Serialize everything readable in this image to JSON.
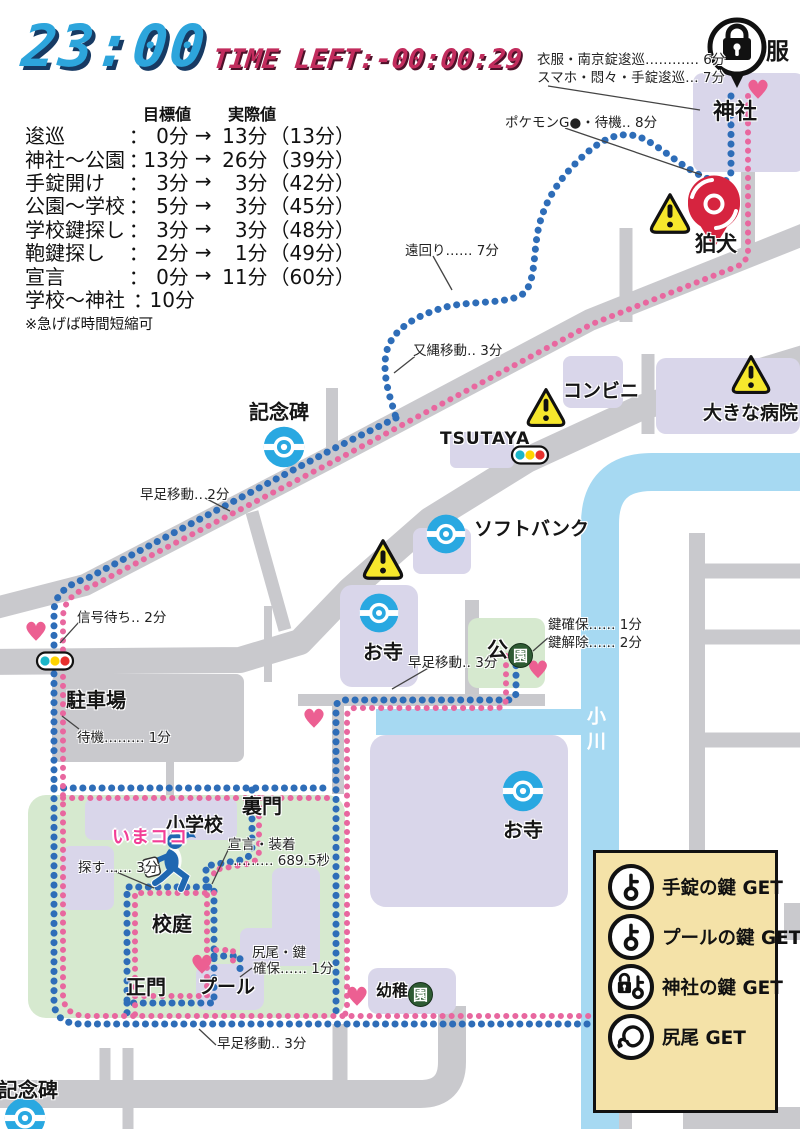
{
  "header": {
    "clock": "23:00",
    "time_left": "TIME LEFT:-00:00:29"
  },
  "schedule": {
    "col_target": "目標値",
    "col_actual": "実際値",
    "arrow": "→",
    "rows": [
      {
        "name": "逡巡",
        "colon": "：",
        "target": "0分",
        "actual": "13分",
        "total": "（13分）"
      },
      {
        "name": "神社～公園",
        "colon": "：",
        "target": "13分",
        "actual": "26分",
        "total": "（39分）"
      },
      {
        "name": "手錠開け",
        "colon": "：",
        "target": "3分",
        "actual": "3分",
        "total": "（42分）"
      },
      {
        "name": "公園～学校",
        "colon": "：",
        "target": "5分",
        "actual": "3分",
        "total": "（45分）"
      },
      {
        "name": "学校鍵探し",
        "colon": "：",
        "target": "3分",
        "actual": "3分",
        "total": "（48分）"
      },
      {
        "name": "鞄鍵探し",
        "colon": "：",
        "target": "2分",
        "actual": "1分",
        "total": "（49分）"
      },
      {
        "name": "宣言",
        "colon": "：",
        "target": "0分",
        "actual": "11分",
        "total": "（60分）"
      },
      {
        "name": "学校～神社",
        "colon": "：",
        "target": "10分",
        "actual": "",
        "total": ""
      }
    ],
    "note": "※急げば時間短縮可"
  },
  "annotations": {
    "clothes_lock": "衣服・南京錠逡巡………… 6分",
    "smartphone": "スマホ・悶々・手錠逡巡… 7分",
    "pokemon_go": "ポケモンG●・待機‥ 8分",
    "detour": "遠回り…… 7分",
    "rope_move": "又縄移動‥ 3分",
    "fast_walk_2": "早足移動‥ 2分",
    "signal_wait": "信号待ち‥ 2分",
    "standby": "待機……… 1分",
    "fast_walk_3_park": "早足移動‥ 3分",
    "key_secure": "鍵確保…… 1分",
    "key_unlock": "鍵解除…… 2分",
    "declare_equip": "宣言・装着",
    "declare_equip_time": "……… 689.5秒",
    "search": "探す…… 3分",
    "tail_key": "尻尾・鍵",
    "tail_key_secure": "確保…… 1分",
    "fast_walk_3_bottom": "早足移動‥ 3分"
  },
  "places": {
    "shrine": "神社",
    "clothes": "服",
    "komainu": "狛犬",
    "monument": "記念碑",
    "convenience_store": "コンビニ",
    "tsutaya": "TSUTAYA",
    "big_hospital": "大きな病院",
    "softbank": "ソフトバンク",
    "temple1": "お寺",
    "park_prefix": "公",
    "park_circled": "園",
    "parking": "駐車場",
    "back_gate": "裏門",
    "elementary_school": "小学校",
    "schoolyard": "校庭",
    "main_gate": "正門",
    "pool": "プール",
    "kindergarten_prefix": "幼稚",
    "kindergarten_circled": "園",
    "temple2": "お寺",
    "monument2": "記念碑",
    "stream": "小川",
    "here_marker": "いまココ"
  },
  "legend": {
    "items": [
      {
        "icon": "handcuff-key-icon",
        "label": "手錠の鍵 GET"
      },
      {
        "icon": "pool-key-icon",
        "label": "プールの鍵 GET"
      },
      {
        "icon": "shrine-lock-key-icon",
        "label": "神社の鍵 GET"
      },
      {
        "icon": "tail-icon",
        "label": "尻尾 GET"
      }
    ]
  },
  "colors": {
    "route_blue": "#2e6db8",
    "route_pink": "#e8679f",
    "road_gray": "#c9c9cd",
    "building_lavender": "#d9d6ea",
    "area_green": "#d6e9cf",
    "river_blue": "#a6d9f2",
    "legend_bg": "#f4e2a8",
    "warning_yellow": "#f6e72c",
    "pin_red": "#d6243f",
    "heart_pink": "#ec5f92",
    "pokestop_blue": "#29a8e1",
    "clock_blue": "#2da5dc",
    "timeleft_crimson": "#c22c5d"
  }
}
